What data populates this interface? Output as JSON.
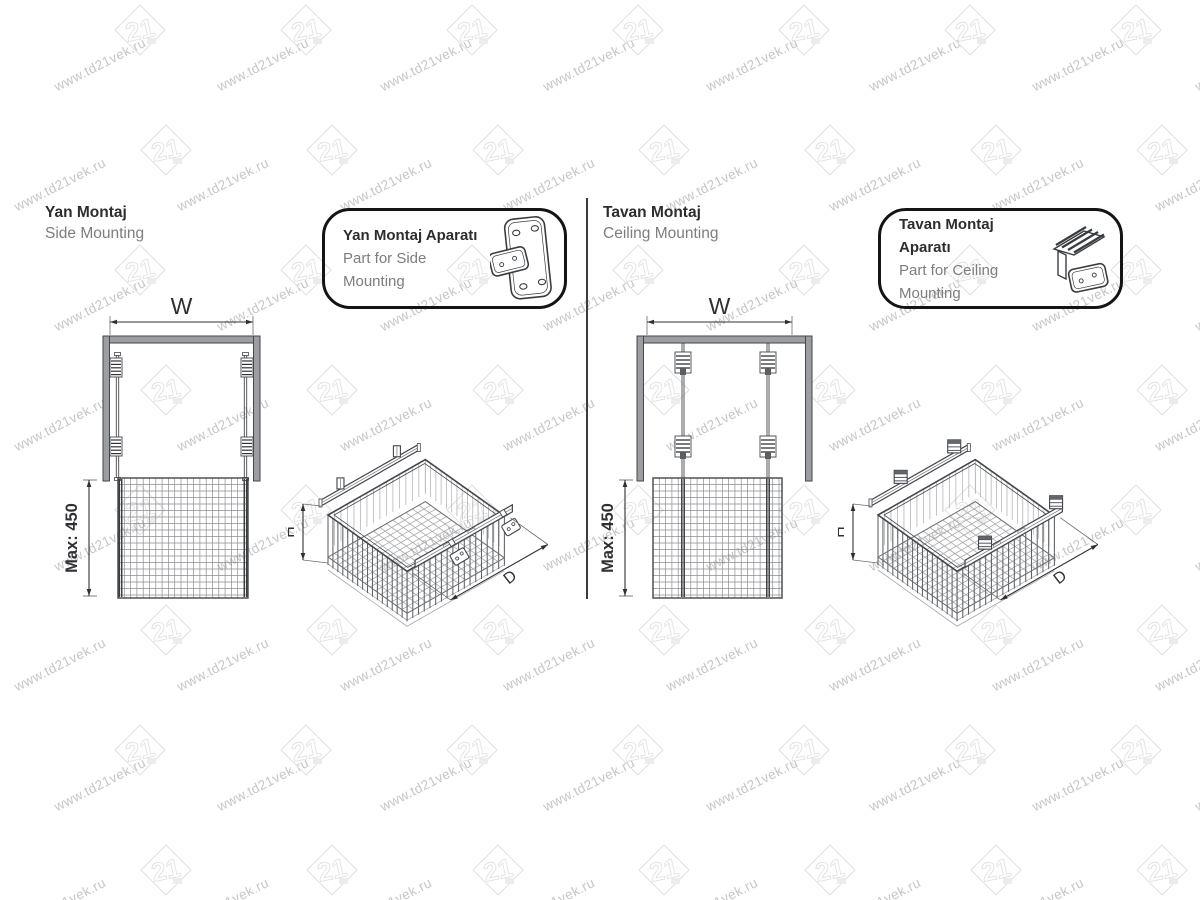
{
  "watermark": {
    "text": "www.td21vek.ru",
    "logo_text": "21"
  },
  "dimensions": {
    "width": "W",
    "height": "H",
    "depth": "D",
    "max_height": "Max: 450"
  },
  "sections": {
    "left": {
      "title_tr": "Yan Montaj",
      "title_en": "Side Mounting",
      "callout_tr": "Yan Montaj Aparatı",
      "callout_en": "Part for Side Mounting"
    },
    "right": {
      "title_tr": "Tavan Montaj",
      "title_en": "Ceiling Mounting",
      "callout_tr": "Tavan Montaj Aparatı",
      "callout_en": "Part for Ceiling Mounting"
    }
  },
  "colors": {
    "line": "#43464a",
    "thin": "#6b6e72",
    "dim": "#2e3033",
    "panel": "#9c9ea1",
    "mesh": "#8b8d90",
    "wire": "#5f6266",
    "wire_back": "#b3b5b7",
    "grid": "#a6a8aa",
    "title": "#2d2d2d",
    "subtitle": "#7d7d7d",
    "watermark_text": "#c6c6c6",
    "watermark_logo": "#e2e2e2"
  }
}
